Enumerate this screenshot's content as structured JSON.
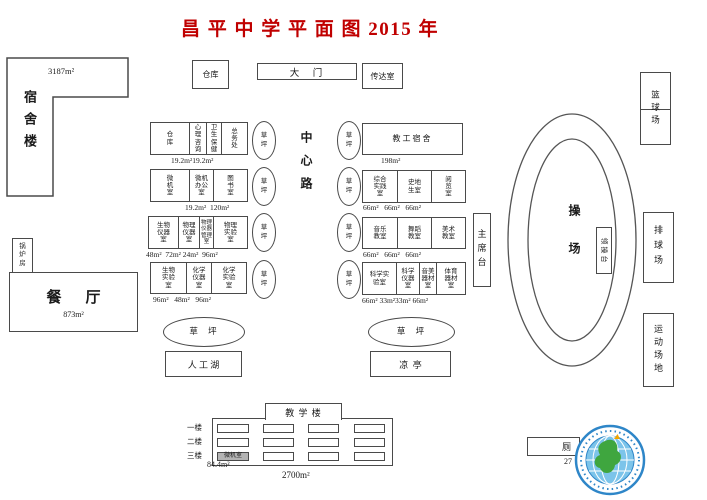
{
  "title": "昌 平 中 学 平 面 图 2015 年",
  "colors": {
    "title_red": "#c00000",
    "line_gray": "#4a4a4a",
    "logo_blue": "#2e86c8",
    "logo_light_blue": "#7cc4ea",
    "logo_green": "#3fa63f",
    "computer_room_gray": "#b4b4b4"
  },
  "top": {
    "dormitory": "宿舍楼",
    "dormitory_area": "3187m²",
    "warehouse": "仓库",
    "gate": "大　门",
    "reception": "传达室"
  },
  "left": {
    "boiler": "锅\n炉\n房",
    "dining": "餐厅",
    "dining_area": "873m²"
  },
  "center_road": "中心路",
  "lawn_v": "草\n坪",
  "lawn_h": "草  坪",
  "left_block": {
    "row1": {
      "c1": "仓\n库",
      "c2": "心\n理\n咨\n询",
      "c3": "卫\n生\n保\n健",
      "c4": "总\n务\n处",
      "areas": "19.2m²19.2m²"
    },
    "row2": {
      "c1": "微\n机\n室",
      "c2": "微机\n办公\n室",
      "c3": "图\n书\n室",
      "areas": "19.2m²  120m²"
    },
    "row3": {
      "c1": "生物\n仪器\n室",
      "c2": "物理\n仪器\n室",
      "c3": "物理\n仪器\n管理\n室",
      "c4": "物理\n实验\n室",
      "areas": "48m²  72m² 24m²  96m²"
    },
    "row4": {
      "c1": "生物\n实验\n室",
      "c2": "化学\n仪器\n室",
      "c3": "化学\n实验\n室",
      "areas": "96m²   48m²   96m²"
    }
  },
  "right_block": {
    "row1": {
      "c1": "教工宿舍",
      "areas": "198m²"
    },
    "row2": {
      "c1": "综合\n实践\n室",
      "c2": "史地\n生室",
      "c3": "阅\n览\n室",
      "areas": "66m²   66m²   66m²"
    },
    "row3": {
      "c1": "音乐\n教室",
      "c2": "舞蹈\n教室",
      "c3": "美术\n教室",
      "areas": "66m²   66m²   66m²"
    },
    "row4": {
      "c1": "科学实\n验室",
      "c2": "科学\n仪器\n室",
      "c3": "音美\n器材\n室",
      "c4": "体育\n器材\n室",
      "areas": "66m² 33m²33m² 66m²"
    }
  },
  "playground": {
    "rostrum": "主席台",
    "name": "操场",
    "platform": "领操台",
    "basketball": "篮球场",
    "volleyball": "排球场",
    "sports_field": "运动场地"
  },
  "bottom": {
    "lake": "人 工 湖",
    "pavilion": "凉  亭"
  },
  "teaching": {
    "name": "教 学 楼",
    "floor1": "一楼",
    "floor2": "二楼",
    "floor3": "三楼",
    "computer_room": "微机室",
    "computer_room_area": "84.4m²",
    "total_area": "2700m²"
  },
  "toilet": {
    "label": "厕",
    "area": "27"
  }
}
